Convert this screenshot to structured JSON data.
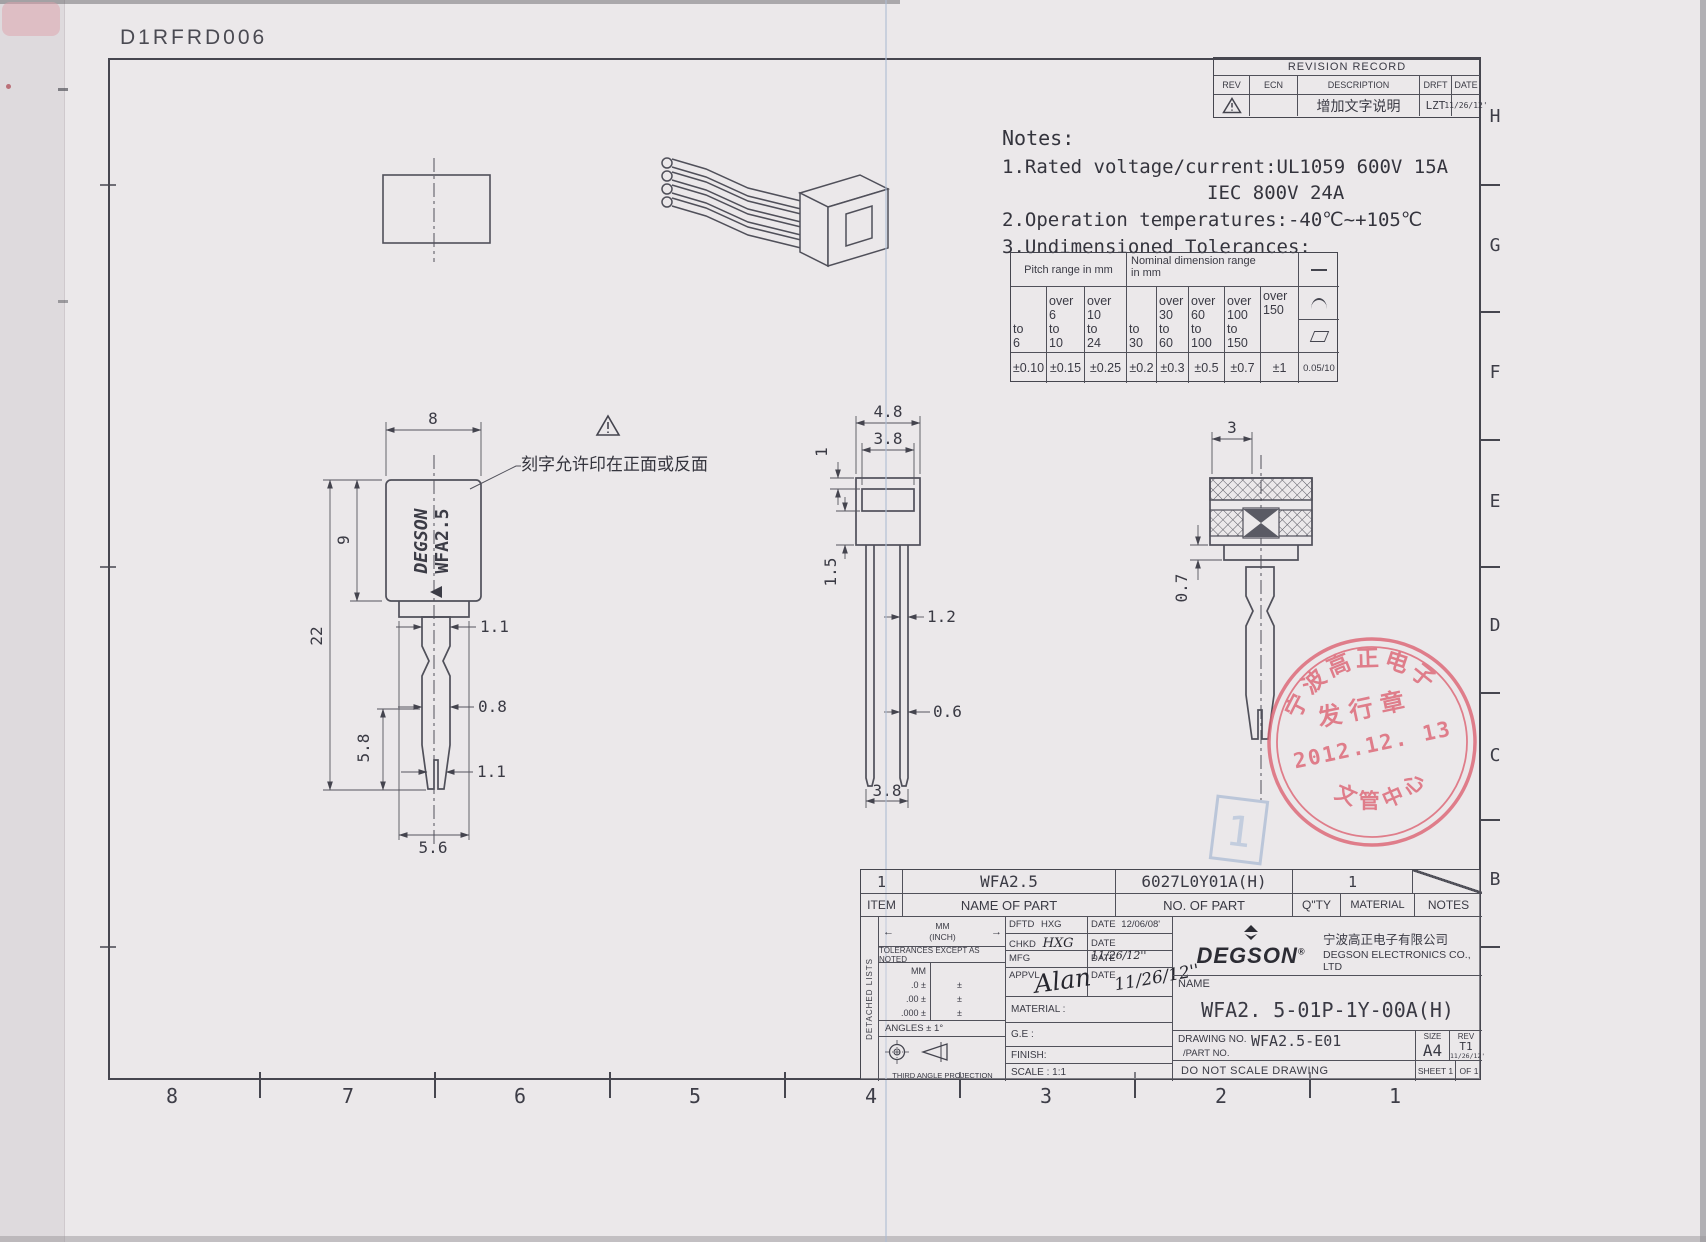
{
  "page": {
    "code": "D1RFRD006"
  },
  "border": {
    "right_letters": [
      "H",
      "G",
      "F",
      "E",
      "D",
      "C",
      "B"
    ],
    "bottom_numbers": [
      "8",
      "7",
      "6",
      "5",
      "4",
      "3",
      "2",
      "1"
    ]
  },
  "revision": {
    "title": "REVISION RECORD",
    "col_rev": "REV",
    "col_ecn": "ECN",
    "col_desc": "DESCRIPTION",
    "col_drft": "DRFT",
    "col_date": "DATE",
    "row_desc": "增加文字说明",
    "row_drft": "LZT",
    "row_date": "11/26/12'"
  },
  "notes": {
    "title": "Notes:",
    "l1": "1.Rated voltage/current:UL1059  600V  15A",
    "l2": "IEC      800V  24A",
    "l3": "2.Operation temperatures:-40℃~+105℃",
    "l4": "3.Undimensioned Tolerances:"
  },
  "tol_table": {
    "pitch_header": "Pitch range in mm",
    "nominal_header": "Nominal dimension range\nin mm",
    "pitch_cols": [
      "to\n6",
      "over\n6\nto\n10",
      "over\n10\nto\n24"
    ],
    "nominal_cols": [
      "to\n30",
      "over\n30\nto\n60",
      "over\n60\nto\n100",
      "over\n100\nto\n150",
      "over\n150"
    ],
    "values": [
      "±0.10",
      "±0.15",
      "±0.25",
      "±0.2",
      "±0.3",
      "±0.5",
      "±0.7",
      "±1",
      "0.05/10"
    ]
  },
  "views": {
    "front": {
      "brand1": "DEGSON",
      "brand2": "WFA2.5",
      "callout": "刻字允许印在正面或反面",
      "dim_width": "8",
      "dim_body_h": "9",
      "dim_total_h": "22",
      "dim_lower": "5.8",
      "dim_pin_top": "1.1",
      "dim_pin_mid": "0.8",
      "dim_pin_bot": "1.1",
      "dim_bottom_w": "5.6"
    },
    "side": {
      "dim_w": "4.8",
      "dim_w2": "3.8",
      "dim_rib": "1",
      "dim_win": "1.5",
      "dim_leg_pair": "1.2",
      "dim_leg": "0.6",
      "dim_bottom": "3.8"
    },
    "right": {
      "dim_top": "3",
      "dim_neck": "0.7"
    }
  },
  "stamp": {
    "arc_top": "宁波高正电子",
    "mid": "发行章",
    "date": "2012.12. 13",
    "arc_bottom": "文管中心"
  },
  "watermark": {
    "label": "1"
  },
  "title_block": {
    "row": {
      "item": "1",
      "name": "WFA2.5",
      "part_no": "6027L0Y01A(H)",
      "qty": "1"
    },
    "head": {
      "item": "ITEM",
      "name": "NAME OF PART",
      "part_no": "NO. OF PART",
      "qty": "Q\"TY",
      "material": "MATERIAL",
      "notes": "NOTES"
    },
    "left": {
      "detached": "DETACHED LISTS",
      "mm_inch": "MM\n(INCH)",
      "tol_note": "TOLERANCES EXCEPT AS NOTED",
      "mm": "MM",
      "r1": ".0 ±",
      "r2": ".00 ±",
      "r3": ".000 ±",
      "pm": "±",
      "angles": "ANGLES ± 1°",
      "projection": "THIRD ANGLE PROJECTION"
    },
    "sign": {
      "dftd": "DFTD",
      "dftd_v": "HXG",
      "date": "DATE",
      "dftd_d": "12/06/08'",
      "chkd": "CHKD",
      "chkd_v": "HXG",
      "chkd_d": "11/26/12''",
      "mfg": "MFG",
      "appvl": "APPVL",
      "appvl_v": "Alan",
      "appvl_d": "11/26/12''",
      "material": "MATERIAL :",
      "ge": "G.E :",
      "finish": "FINISH:",
      "scale": "SCALE : 1:1"
    },
    "company": {
      "logo": "DEGSON",
      "reg": "®",
      "cn": "宁波高正电子有限公司",
      "en": "DEGSON ELECTRONICS CO., LTD"
    },
    "name_label": "NAME",
    "part_name": "WFA2. 5-01P-1Y-00A(H)",
    "drawing_no_label": "DRAWING NO.",
    "drawing_no": "WFA2.5-E01",
    "part_no_label": "/PART  NO.",
    "size_label": "SIZE",
    "size": "A4",
    "rev_label": "REV",
    "rev": "T1",
    "rev_date": "11/26/12'",
    "do_not_scale": "DO NOT SCALE DRAWING",
    "sheet": "SHEET 1",
    "of": "OF 1"
  }
}
